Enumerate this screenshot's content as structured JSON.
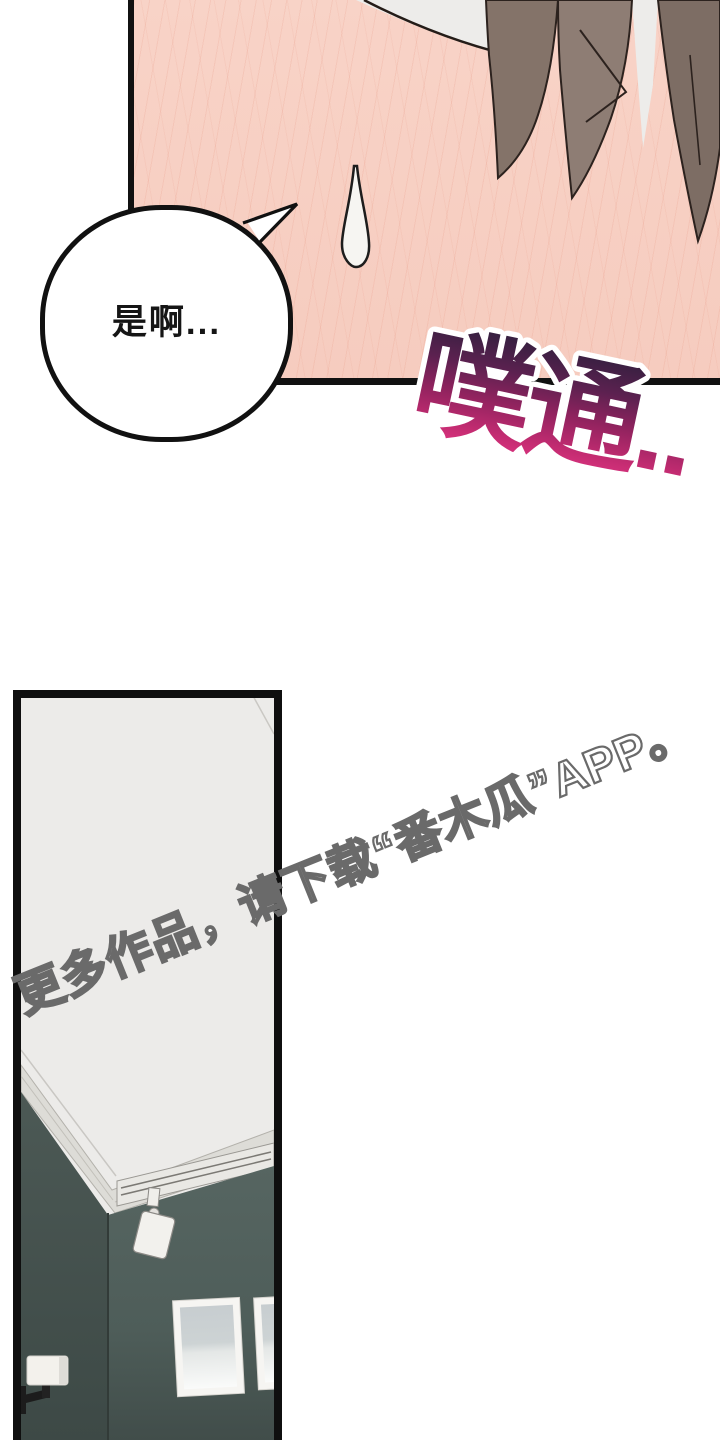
{
  "page": {
    "width": 720,
    "height": 1440,
    "background": "#ffffff"
  },
  "panel_top": {
    "speech_bubble": {
      "text": "是啊...",
      "fill": "#ffffff",
      "border": "#111111"
    },
    "sfx": {
      "text": "噗通..",
      "outline": "#ffffff",
      "gradient": [
        "#31203e",
        "#5c2150",
        "#93235f",
        "#c52c72",
        "#e53786"
      ]
    },
    "colors": {
      "skin": "#f7d0c4",
      "skin_line": "#e89884",
      "hair_left": "#847369",
      "hair_center": "#8e7d74",
      "hair_right": "#7d6d64",
      "hair_outline": "#2c221e",
      "bg_white": "#edecea",
      "sweat_drop": "#f6f5f2",
      "panel_border": "#111111"
    }
  },
  "watermark": {
    "text": "更多作品，请下载“番木瓜”APP。",
    "fill": "#ffffff",
    "outline": "#6a6a6a"
  },
  "panel_room": {
    "colors": {
      "ceiling": "#ecebe9",
      "molding": "#dddcd7",
      "rail": "#e9e8e4",
      "wall_right": "#4e5d59",
      "wall_left": "#455350",
      "corner_line": "#323b38",
      "frame": "#f6f5f2",
      "picture_top": "#c7cdd0",
      "picture_bottom": "#fafbfa",
      "sconce_shade": "#f3f1ec",
      "sconce_arm": "#1c1c1c",
      "spotlight": "#f2f1ed",
      "panel_border": "#0f0f0f"
    }
  }
}
